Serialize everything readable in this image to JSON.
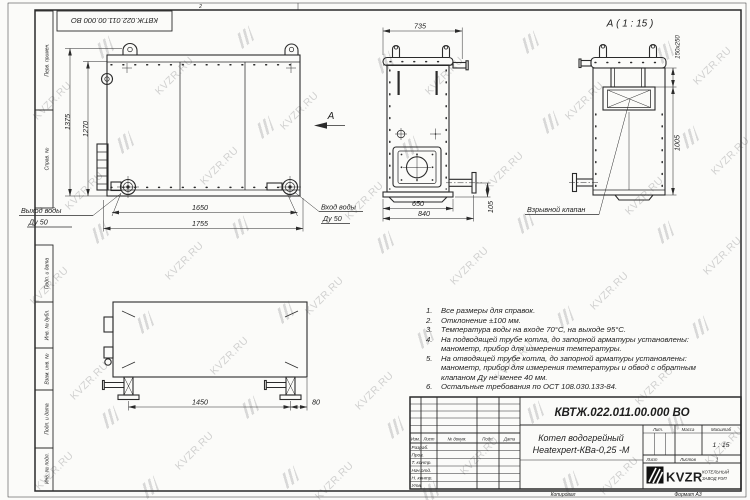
{
  "sheet": {
    "stamp_top": "КВТЖ.022.011.00.000 ВО",
    "zone_marker": "2",
    "copied_label": "Копировал",
    "format_label": "Формат А3"
  },
  "frame": {
    "labels": [
      "Перв. примен.",
      "Справ. №",
      "Подп. и дата",
      "Инв. № дубл.",
      "Взам. инв. №",
      "Подп. и дата",
      "Инв. № подл."
    ]
  },
  "views": {
    "front": {
      "dim_height_outer": "1375",
      "dim_height_inner": "1270",
      "dim_width_inner": "1650",
      "dim_width_outer": "1755",
      "outlet_label": "Выход воды",
      "outlet_dn": "Ду 50",
      "inlet_label": "Вход воды",
      "inlet_dn": "Ду 50",
      "view_arrow": "А"
    },
    "side": {
      "dim_width_top": "735",
      "dim_width_inner": "650",
      "dim_width_outer": "840",
      "dim_offset": "105"
    },
    "detail": {
      "title": "А ( 1 : 15 )",
      "dim_valve": "150x250",
      "dim_height": "1005",
      "valve_label": "Взрывной клапан"
    },
    "bottom": {
      "dim_span": "1450",
      "dim_offset": "80"
    }
  },
  "notes": {
    "lines": [
      {
        "num": "1.",
        "text": "Все размеры для справок."
      },
      {
        "num": "2.",
        "text": "Отклонение ±100 мм."
      },
      {
        "num": "3.",
        "text": "Температура воды на входе 70°С, на выходе 95°С."
      },
      {
        "num": "4.",
        "text": "На подводящей трубе котла, до запорной арматуры установлены:"
      },
      {
        "num": "",
        "text": "манометр, прибор для измерения температуры."
      },
      {
        "num": "5.",
        "text": "На отводящей трубе котла, до запорной арматуры установлены:"
      },
      {
        "num": "",
        "text": "манометр, прибор для измерения температуры и обвод с обратным"
      },
      {
        "num": "",
        "text": "клапаном Ду не менее 40 мм."
      },
      {
        "num": "6.",
        "text": "Остальные требования по ОСТ 108.030.133-84."
      }
    ]
  },
  "title_block": {
    "doc_number": "КВТЖ.022.011.00.000 ВО",
    "product_line1": "Котел водогрейный",
    "product_line2": "Heatexpert-КВа-0,25 -М",
    "header": {
      "izm": "Изм.",
      "list": "Лист",
      "doc": "№ докум.",
      "podp": "Подп.",
      "data": "Дата"
    },
    "rows": [
      "Разраб.",
      "Пров.",
      "Т. контр.",
      "Нач.отд.",
      "Н. контр.",
      "Утв."
    ],
    "grid": {
      "lit": "Лит.",
      "mass": "Масса",
      "scale": "Масштаб",
      "scale_value": "1 : 15",
      "sheet": "Лист",
      "sheets": "Листов",
      "sheets_value": "1"
    },
    "company": {
      "logo": "KVZR",
      "line1": "КОТЕЛЬНЫЙ",
      "line2": "ЗАВОД РЭП"
    }
  },
  "watermark": {
    "text": "KVZR.RU"
  },
  "colors": {
    "line": "#2b2b2b",
    "paper": "#fbfbf9",
    "watermark": "#c7c7c7",
    "logo_bg": "#111111"
  }
}
